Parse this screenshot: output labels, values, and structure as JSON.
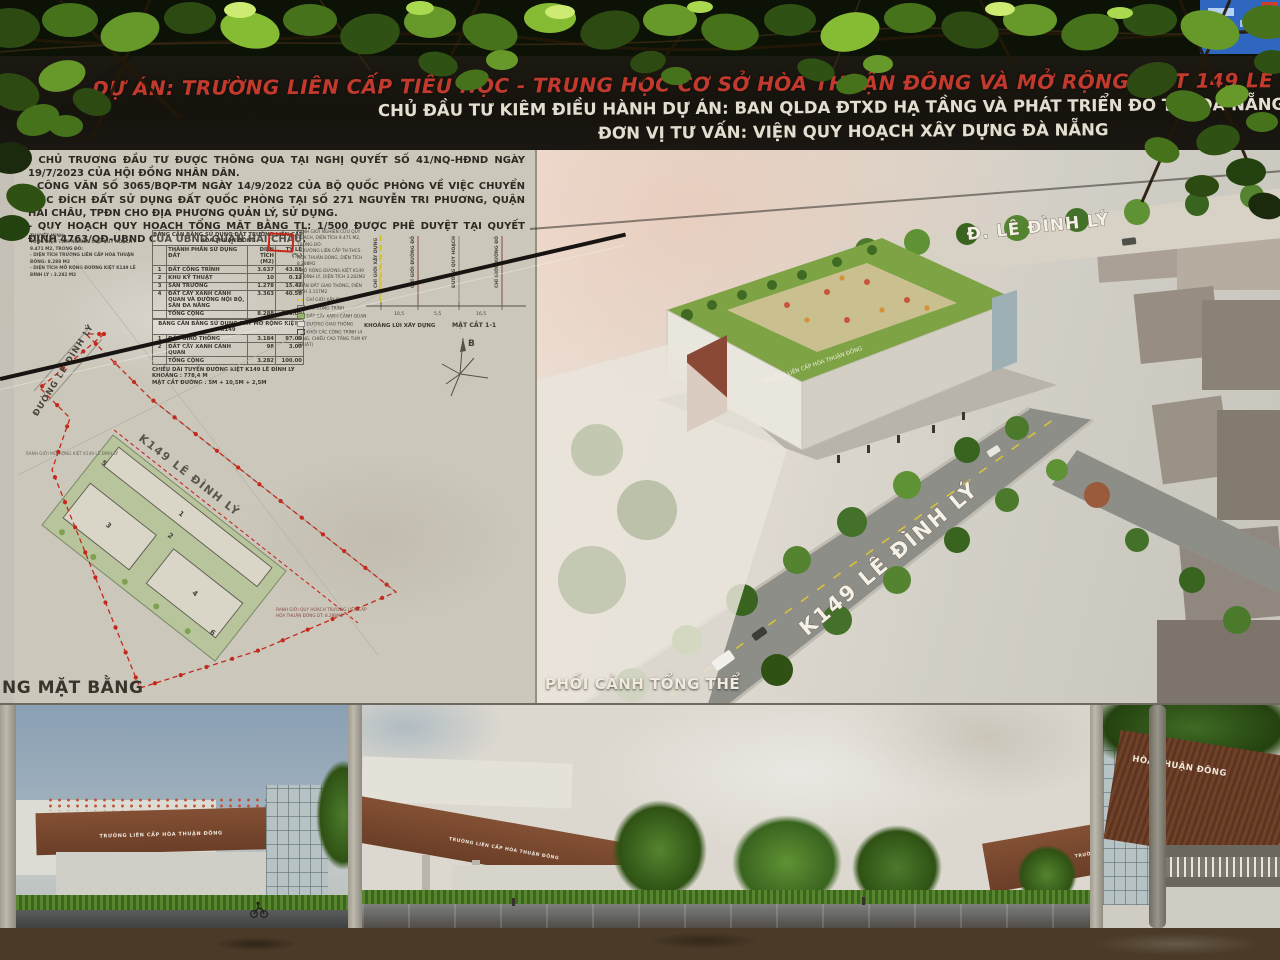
{
  "header": {
    "title": "DỰ ÁN: TRƯỜNG LIÊN CẤP TIỂU HỌC - TRUNG HỌC CƠ SỞ  HÒA THUẬN ĐÔNG VÀ MỞ RỘNG KIỆT 149 LÊ ĐÌNH LÝ",
    "investor_line": "CHỦ ĐẦU TƯ KIÊM ĐIỀU HÀNH DỰ ÁN: BAN QLDA ĐTXD HẠ TẦNG VÀ PHÁT TRIỂN ĐÔ THỊ ĐÀ NẴNG",
    "consultant_line": "ĐƠN VỊ TƯ VẤN: VIỆN QUY HOẠCH XÂY DỰNG ĐÀ NẴNG"
  },
  "notes": {
    "items": [
      "- CHỦ TRƯƠNG ĐẦU TƯ ĐƯỢC THÔNG QUA TẠI NGHỊ QUYẾT SỐ 41/NQ-HĐND NGÀY 19/7/2023 CỦA HỘI ĐỒNG NHÂN DÂN.",
      "- CÔNG VĂN SỐ 3065/BQP-TM NGÀY 14/9/2022 CỦA BỘ QUỐC PHÒNG VỀ VIỆC CHUYỂN MỤC ĐÍCH ĐẤT SỬ DỤNG ĐẤT QUỐC PHÒNG TẠI SỐ 271 NGUYỄN TRI PHƯƠNG, QUẬN HẢI CHÂU, TPĐN CHO ĐỊA PHƯƠNG QUẢN LÝ, SỬ DỤNG.",
      "- QUY HOẠCH QUY HOẠCH TỔNG MẶT BẰNG TL: 1/500 ĐƯỢC PHÊ DUYỆT TẠI QUYẾT ĐỊNH 4763/QĐ-UBND CỦA UBND QUẬN HẢI CHÂU."
    ]
  },
  "thuyet_minh": {
    "title": "THUYẾT MINH:",
    "lines": [
      "TỔNG DIỆN TÍCH NGHIÊN CỨU QUY HOẠCH : 9.471 M2, TRONG ĐÓ:",
      "- DIỆN TÍCH TRƯỜNG LIÊN CẤP HÒA THUẬN ĐÔNG: 8.288 M2",
      "- DIỆN TÍCH MỞ RỘNG ĐƯỜNG KIỆT K149 LÊ ĐÌNH LÝ : 3.282 M2"
    ]
  },
  "table1": {
    "title": "BẢNG CÂN BẰNG SỬ DỤNG ĐẤT TRƯỜNG LIÊN CẤP HÒA THUẬN ĐÔNG",
    "col_name": "THÀNH PHẦN SỬ DỤNG ĐẤT",
    "col_area": "DIỆN TÍCH (M2)",
    "col_pct": "TỶ LỆ (%)",
    "rows": [
      {
        "n": "1",
        "name": "ĐẤT CÔNG TRÌNH",
        "area": "3.637",
        "pct": "43.88"
      },
      {
        "n": "2",
        "name": "KHU KỸ THUẬT",
        "area": "10",
        "pct": "0.12"
      },
      {
        "n": "3",
        "name": "SÂN TRƯỜNG",
        "area": "1.278",
        "pct": "15.42"
      },
      {
        "n": "4",
        "name": "ĐẤT CÂY XANH CẢNH QUAN VÀ ĐƯỜNG NỘI BỘ, SÂN ĐA NĂNG",
        "area": "3.363",
        "pct": "40.58"
      },
      {
        "n": "",
        "name": "TỔNG CỘNG",
        "area": "8.288",
        "pct": "100.00"
      }
    ]
  },
  "table2": {
    "title": "BẢNG CÂN BẰNG SỬ DỤNG ĐẤT MỞ RỘNG KIỆT K149",
    "rows": [
      {
        "n": "1",
        "name": "ĐẤT GIAO THÔNG",
        "area": "3.184",
        "pct": "97.00"
      },
      {
        "n": "2",
        "name": "ĐẤT CÂY XANH CẢNH QUAN",
        "area": "98",
        "pct": "3.00"
      },
      {
        "n": "",
        "name": "TỔNG CỘNG",
        "area": "3.282",
        "pct": "100.00"
      }
    ],
    "notes": [
      "CHIỀU DÀI TUYẾN ĐƯỜNG KIỆT K149 LÊ ĐÌNH LÝ KHOẢNG : 778,4 M",
      "MẶT CẮT ĐƯỜNG : 5M + 10,5M + 2,5M"
    ]
  },
  "legend_notes": {
    "items": [
      "RANH GIỚI NGHIÊN CỨU QUY HOẠCH, DIỆN TÍCH 9.471 M2, TRONG ĐÓ:",
      "- TRƯỜNG LIÊN CẤP TH-THCS HÒA THUẬN ĐÔNG, DIỆN TÍCH 8.288M2",
      "- MỞ RỘNG ĐƯỜNG KIỆT K149 LÊ ĐÌNH LÝ, DIỆN TÍCH 3.282M2",
      "PHẦN ĐẤT GIAO THÔNG, DIỆN TÍCH 3.157M2",
      "CHỈ GIỚI XÂY DỰNG",
      "ĐẤT CÔNG TRÌNH",
      "ĐẤT CÂY XANH CẢNH QUAN",
      "ĐƯỜNG GIAO THÔNG",
      "KHỐI CÁC CÔNG TRÌNH (4 TẦNG, CHIỀU CAO TẦNG TUM KỸ THUẬT)"
    ]
  },
  "section": {
    "labels": [
      "CHỈ GIỚI XÂY DỰNG",
      "CHỈ GIỚI ĐƯỜNG ĐỎ",
      "ĐƯỜNG QUY HOẠCH",
      "CHỈ GIỚI ĐƯỜNG ĐỎ"
    ],
    "dims": [
      "10,5",
      "5,5",
      "16,5"
    ],
    "caption_left": "KHOẢNG LÙI XÂY DỰNG",
    "caption_right": "MẶT CẮT 1-1"
  },
  "plan": {
    "street_label": "ĐƯỜNG LÊ ĐÌNH LÝ",
    "road_label": "K149 LÊ ĐÌNH LÝ",
    "boundary_note_1": "RANH GIỚI MỞ RỘNG KIỆT K149 LÊ ĐÌNH LÝ",
    "boundary_note_2a": "RANH GIỚI QUY HOẠCH TRƯỜNG LIÊN CẤP",
    "boundary_note_2b": "HÒA THUẬN ĐÔNG DT: 8.288M2",
    "compass_label": "B",
    "caption": "NG MẶT BẰNG",
    "block_numbers": [
      "1",
      "2",
      "3",
      "4",
      "5",
      "6"
    ]
  },
  "chu_thich": {
    "title": "CHÚ THÍCH:",
    "items": [
      {
        "num": "1",
        "label": "KHỐI LỚP HỌC + HIỆU BỘ"
      },
      {
        "num": "2",
        "label": "SÂN TRƯỜNG"
      },
      {
        "num": "3",
        "label": "KHỐI LỚP HỌC"
      },
      {
        "num": "4",
        "label": "KHỐI LỚP HỌC"
      },
      {
        "num": "5",
        "label": "CỔNG VÀO CHÍNH"
      },
      {
        "num": "6",
        "label": "KHU KỸ THUẬT"
      }
    ]
  },
  "perspective": {
    "caption": "PHỐI CẢNH TỔNG THỂ",
    "street_top_label": "Đ. LÊ ĐÌNH LÝ",
    "street_diag_label": "K149 LÊ ĐÌNH LÝ",
    "building_label": "TRƯỜNG LIÊN CẤP HÒA THUẬN ĐÔNG"
  },
  "bottom": {
    "panel1_building_label": "TRƯỜNG LIÊN CẤP HÒA THUẬN ĐÔNG",
    "panel2_building_label": "TRƯỜNG LIÊN CẤP HÒA THUẬN ĐÔNG",
    "panel2_building_label_right": "TRƯỜNG LIÊN CẤP HÒA THUẬN ĐÔNG",
    "panel3_canopy_label": "HÒA THUẬN ĐÔNG"
  },
  "colors": {
    "title_red": "#c23a2e",
    "subtitle_cream": "#e3decf",
    "boundary_red": "#c5281c",
    "roof_green": "#7da344",
    "band_brown": "#7c4a31",
    "sign_blue": "#2f66c0",
    "board_gray": "#c6c1b6"
  }
}
